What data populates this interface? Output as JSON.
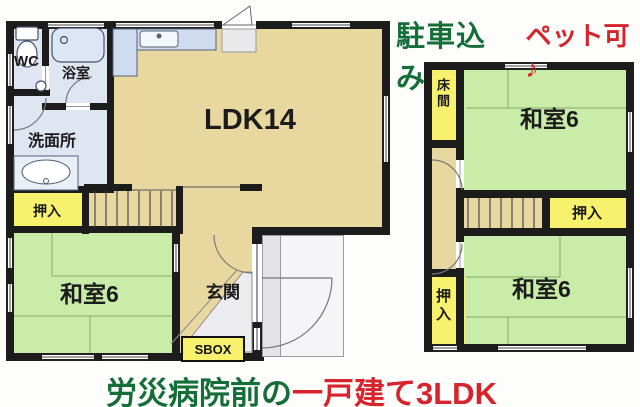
{
  "headline": {
    "parking": "駐車込み",
    "pets": "ペット可♪"
  },
  "footline": {
    "location": "労災病院前の",
    "property": "一戸建て3LDK"
  },
  "floor1": {
    "wc": "WC",
    "bath": "浴室",
    "washroom": "洗面所",
    "ldk": "LDK14",
    "closet": "押入",
    "japanese_room": "和室6",
    "entrance": "玄関",
    "shoe_box": "SBOX"
  },
  "floor2": {
    "tokonoma": "床間",
    "japanese_room_upper": "和室6",
    "closet_upper": "押入",
    "japanese_room_lower": "和室6",
    "closet_lower": "押入"
  },
  "colors": {
    "wall": "#1c1c1c",
    "tan": "#e8d8a0",
    "tatami_green": "#c9eca8",
    "closet_yellow": "#f8f16e",
    "wet_blue": "#dfe5f1",
    "genkan_gray": "#ececef",
    "porch_gray": "#f5f5f7",
    "accent_green": "#156e39",
    "accent_red": "#d7232c"
  }
}
